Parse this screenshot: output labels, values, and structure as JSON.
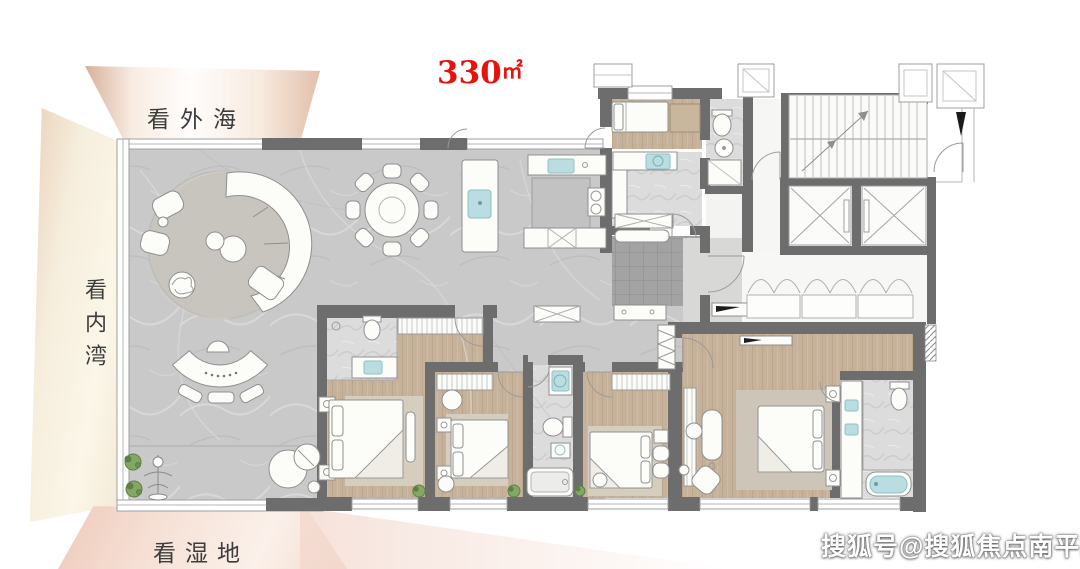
{
  "area_label": {
    "value": "330",
    "unit": "㎡"
  },
  "view_labels": {
    "top": "看外海",
    "left": "看内湾",
    "bottom": "看湿地"
  },
  "watermark": "搜狐号@搜狐焦点南平站",
  "colors": {
    "accent_red": "#e8120d",
    "label_ink": "#3c3c3c",
    "wall": "#6d6d6d",
    "marble_base": "#c9c9c9",
    "wood_floor": "#c6b29a",
    "bath_floor": "#dcdcdc",
    "foyer_tile": "#a3a3a3",
    "fixture_teal": "#b9dde0",
    "plant_green": "#83a765",
    "decor_peach": "#e2bfab",
    "decor_cream": "#f6eedd",
    "decor_pink": "#eec9ba",
    "watermark_white": "#ffffff"
  }
}
